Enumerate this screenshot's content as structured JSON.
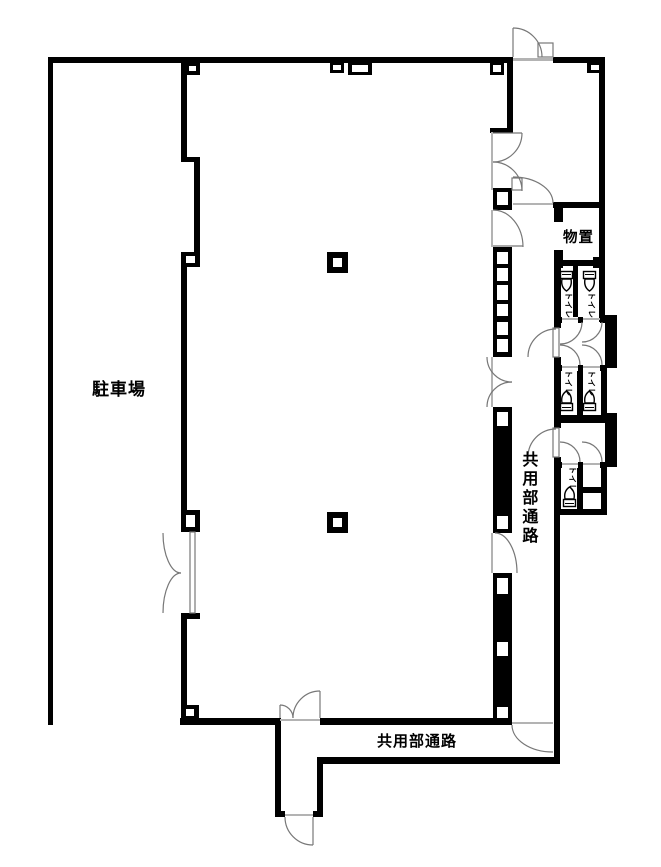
{
  "drawing_title": "floor-plan",
  "colors": {
    "wall": "#000000",
    "door_line": "#777777",
    "threshold": "#b3b3b3",
    "background": "#ffffff",
    "text": "#000000"
  },
  "rooms": {
    "parking": {
      "label": "駐車場"
    },
    "storage": {
      "label": "物置"
    },
    "corridor_side": {
      "label": "共用部通路"
    },
    "corridor_bottom": {
      "label": "共用部通路"
    },
    "toilets": {
      "label": "トイレ",
      "count": 5
    }
  }
}
